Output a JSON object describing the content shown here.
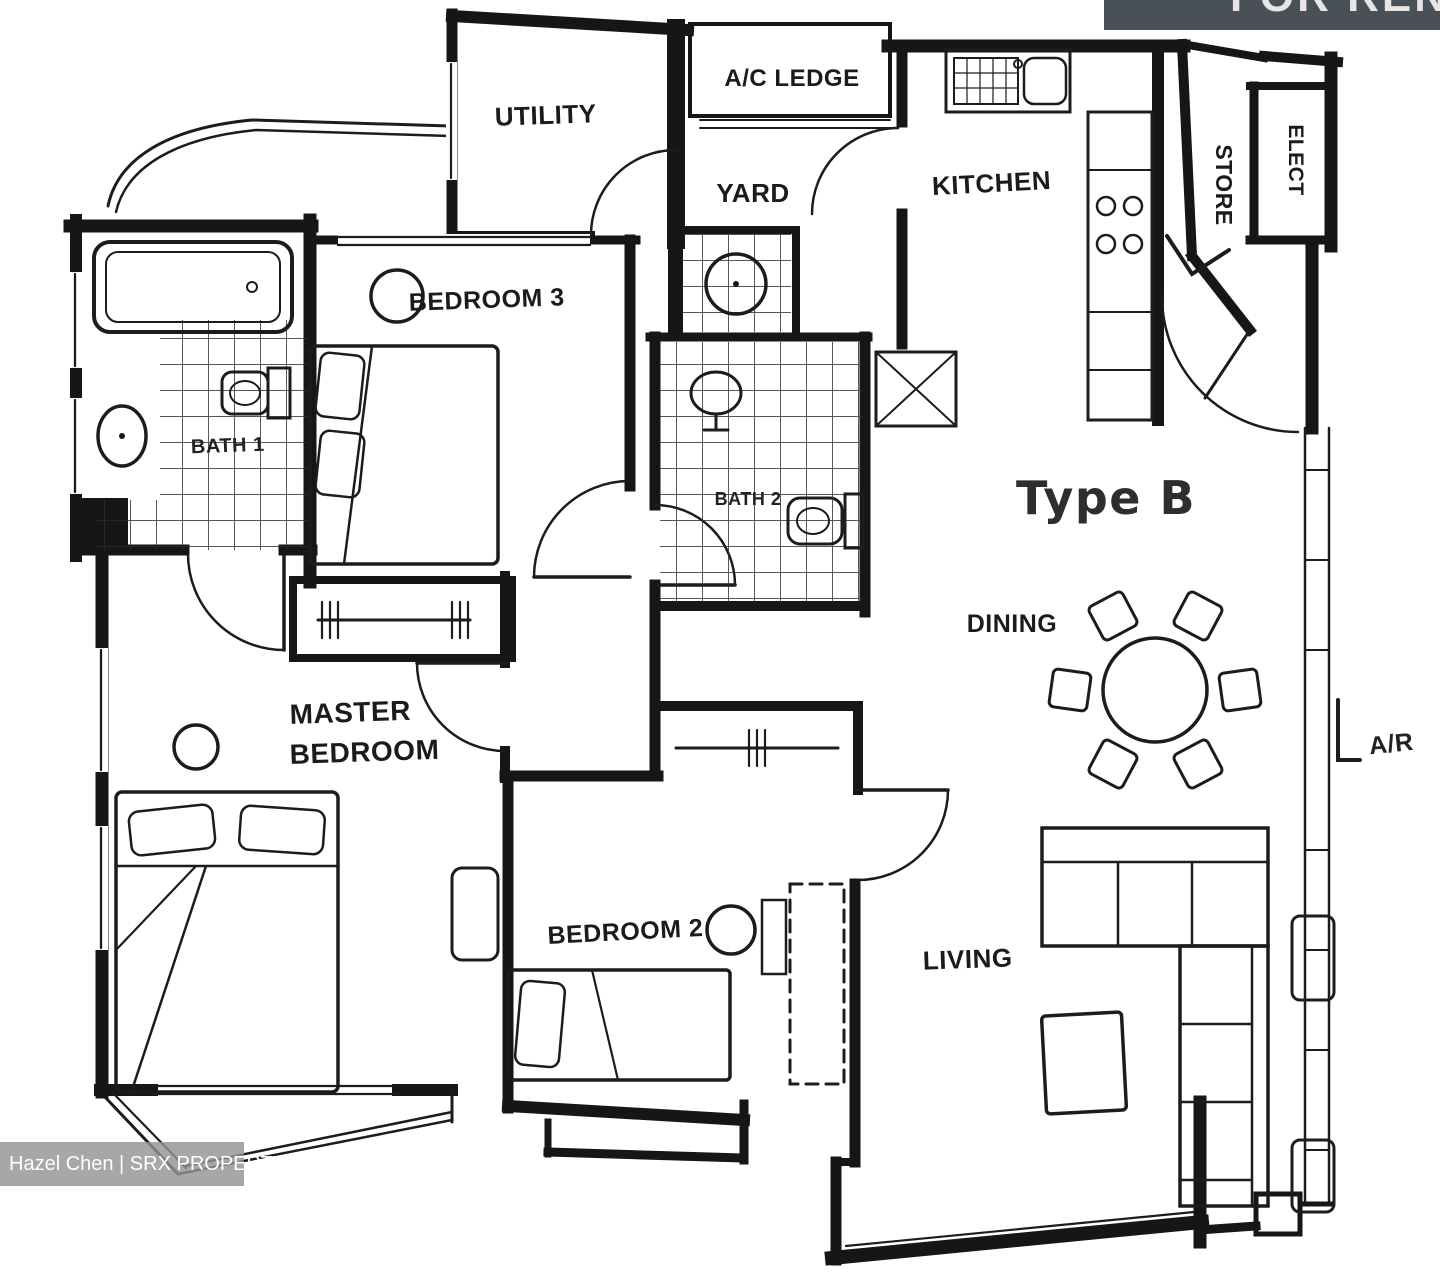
{
  "banner": {
    "label": "FOR RENT",
    "bg_color": "#4a5057",
    "text_color": "#e9e4e6"
  },
  "watermark": {
    "label": "Hazel Chen | SRX PROPERTY"
  },
  "plan": {
    "title": "Type B",
    "ink_color": "#1a1a1a",
    "rooms": {
      "utility": "UTILITY",
      "ac_ledge": "A/C LEDGE",
      "yard": "YARD",
      "kitchen": "KITCHEN",
      "store": "STORE",
      "elect": "ELECT",
      "bedroom3": "BEDROOM 3",
      "bath1": "BATH 1",
      "bath2": "BATH 2",
      "dining": "DINING",
      "master_line1": "MASTER",
      "master_line2": "BEDROOM",
      "bedroom2": "BEDROOM 2",
      "living": "LIVING"
    },
    "annotation": "A/R"
  }
}
